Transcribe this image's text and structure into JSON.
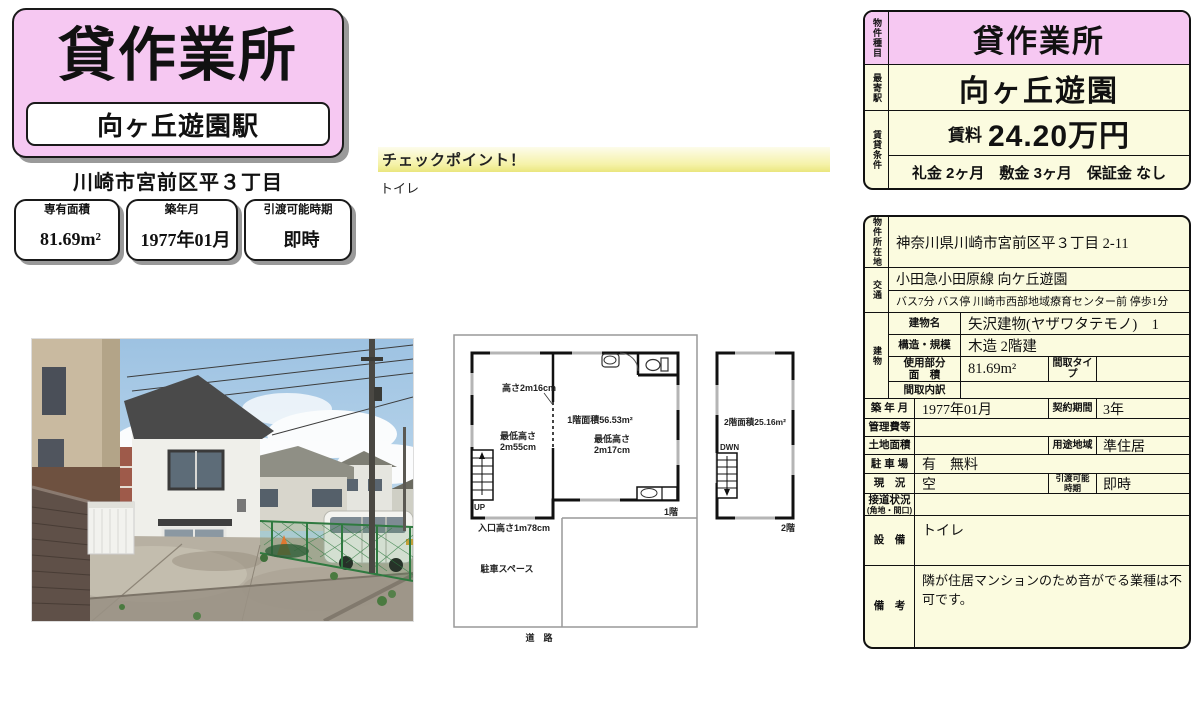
{
  "colors": {
    "pink": "#f6c8f2",
    "cream": "#fbfbdf",
    "border": "#111111",
    "shadow": "#999999"
  },
  "header": {
    "property_type": "貸作業所",
    "station": "向ヶ丘遊園駅",
    "address": "川崎市宮前区平３丁目",
    "info_boxes": [
      {
        "label": "専有面積",
        "value": "81.69m²"
      },
      {
        "label": "築年月",
        "value": "1977年01月"
      },
      {
        "label": "引渡可能時期",
        "value": "即時"
      }
    ]
  },
  "checkpoint": {
    "title": "チェックポイント！",
    "note": "トイレ"
  },
  "summary_card": {
    "type_label": "物件種目",
    "type_value": "貸作業所",
    "station_label": "最寄駅",
    "station_value": "向ヶ丘遊園",
    "terms_label": "賃貸条件",
    "rent_label": "賃料",
    "rent_value": "24.20万円",
    "terms": "礼金 2ヶ月　敷金 3ヶ月　保証金 なし"
  },
  "floorplan": {
    "f1": {
      "height_note": "高さ2m16cm",
      "area": "1階面積56.53m²",
      "min_left1": "最低高さ",
      "min_left2": "2m55cm",
      "min_right1": "最低高さ",
      "min_right2": "2m17cm",
      "up": "UP",
      "entrance": "入口高さ1m78cm",
      "floor": "1階",
      "parking": "駐車スペース",
      "road": "道　路"
    },
    "f2": {
      "area": "2階面積25.16m²",
      "down": "DWN",
      "floor": "2階"
    }
  },
  "detail_card": {
    "location": {
      "label": "物件所在地",
      "value": "神奈川県川崎市宮前区平３丁目 2-11"
    },
    "transport": {
      "label": "交通",
      "line1": "小田急小田原線 向ケ丘遊園",
      "line2": "バス7分 バス停 川崎市西部地域療育センター前 停歩1分"
    },
    "building": {
      "label": "建物",
      "name_label": "建物名",
      "name": "矢沢建物(ヤザワタテモノ)　1",
      "structure_label": "構造・規模",
      "structure": "木造 2階建",
      "area_label1": "使用部分",
      "area_label2": "面　積",
      "area": "81.69m²",
      "layout_type_label": "間取タイプ",
      "layout_type": "",
      "layout_detail_label": "間取内訳",
      "layout_detail": ""
    },
    "built": {
      "label": "築 年 月",
      "value": "1977年01月",
      "label2": "契約期間",
      "value2": "3年"
    },
    "management": {
      "label": "管理費等",
      "value": ""
    },
    "land": {
      "label": "土地面積",
      "value": "",
      "label2": "用途地域",
      "value2": "準住居"
    },
    "parking": {
      "label": "駐 車 場",
      "value": "有　無料"
    },
    "status": {
      "label": "現　況",
      "value": "空",
      "label2a": "引渡可能",
      "label2b": "時期",
      "value2": "即時"
    },
    "road": {
      "label1": "接道状況",
      "label2": "(角地・間口)",
      "value": ""
    },
    "equipment": {
      "label": "設　備",
      "value": "トイレ"
    },
    "remarks": {
      "label": "備　考",
      "value": "隣が住居マンションのため音がでる業種は不可です。"
    }
  }
}
